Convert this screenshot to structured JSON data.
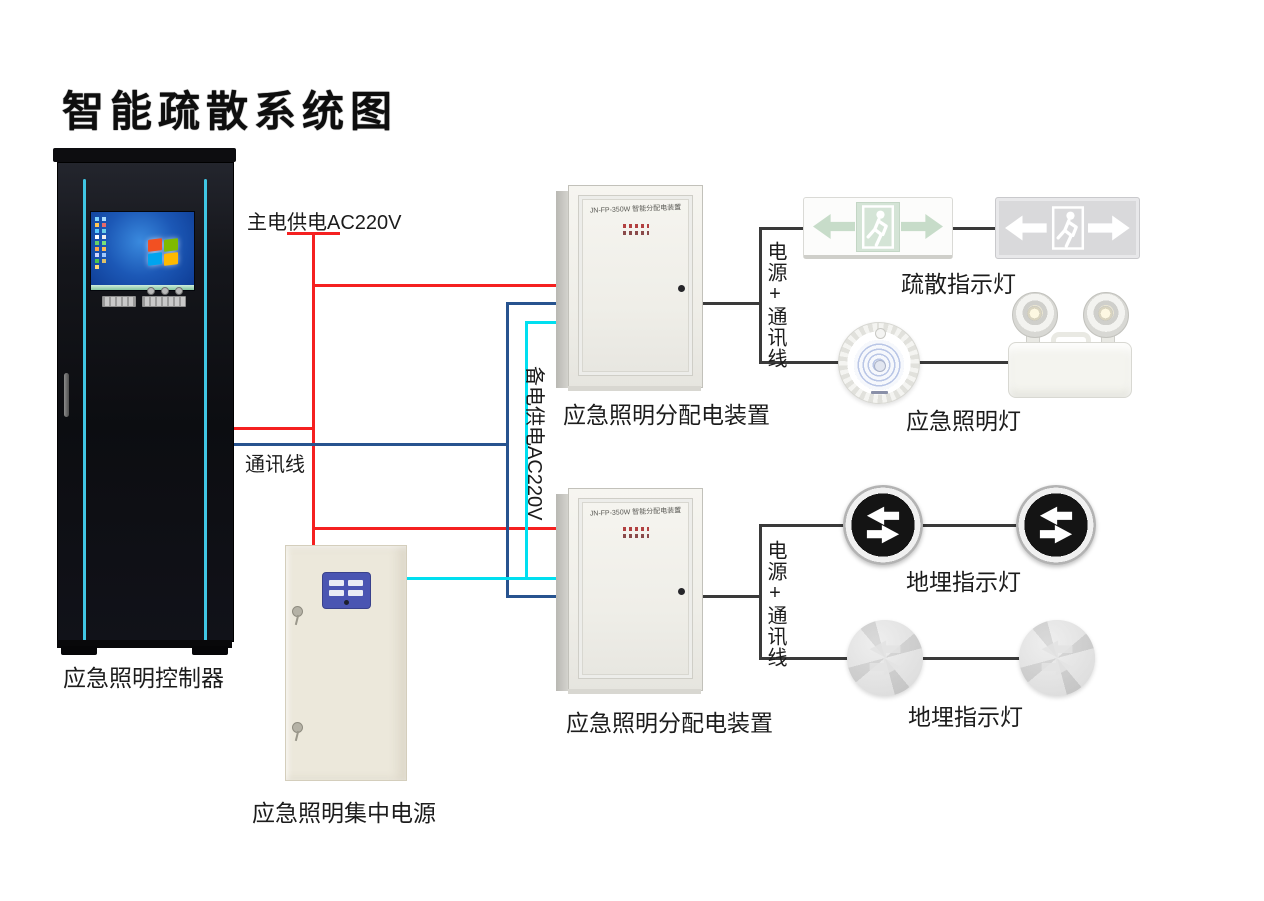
{
  "title": "智能疏散系统图",
  "wiring": {
    "main_power_label": "主电供电AC220V",
    "comm_label": "通讯线",
    "backup_power_label": "备电供电AC220V",
    "branch_label_top": "电源+通讯线",
    "branch_label_bottom": "电源+通讯线"
  },
  "devices": {
    "controller_label": "应急照明控制器",
    "central_power_label": "应急照明集中电源",
    "distribution_box_top_label": "应急照明分配电装置",
    "distribution_box_bottom_label": "应急照明分配电装置",
    "distribution_box_model": "JN-FP-350W 智能分配电装置",
    "exit_sign_label": "疏散指示灯",
    "emergency_lamp_label": "应急照明灯",
    "ground_lamp_top_label": "地埋指示灯",
    "ground_lamp_bottom_label": "地埋指示灯"
  },
  "colors": {
    "main_power_line": "#f52020",
    "comm_line": "#27538f",
    "backup_power_line": "#00dff0",
    "connector_line": "#3a3a3a",
    "cabinet_accent": "#40c6e4",
    "windows_logo": [
      "#f25022",
      "#7fba00",
      "#00a4ef",
      "#ffb900"
    ]
  }
}
